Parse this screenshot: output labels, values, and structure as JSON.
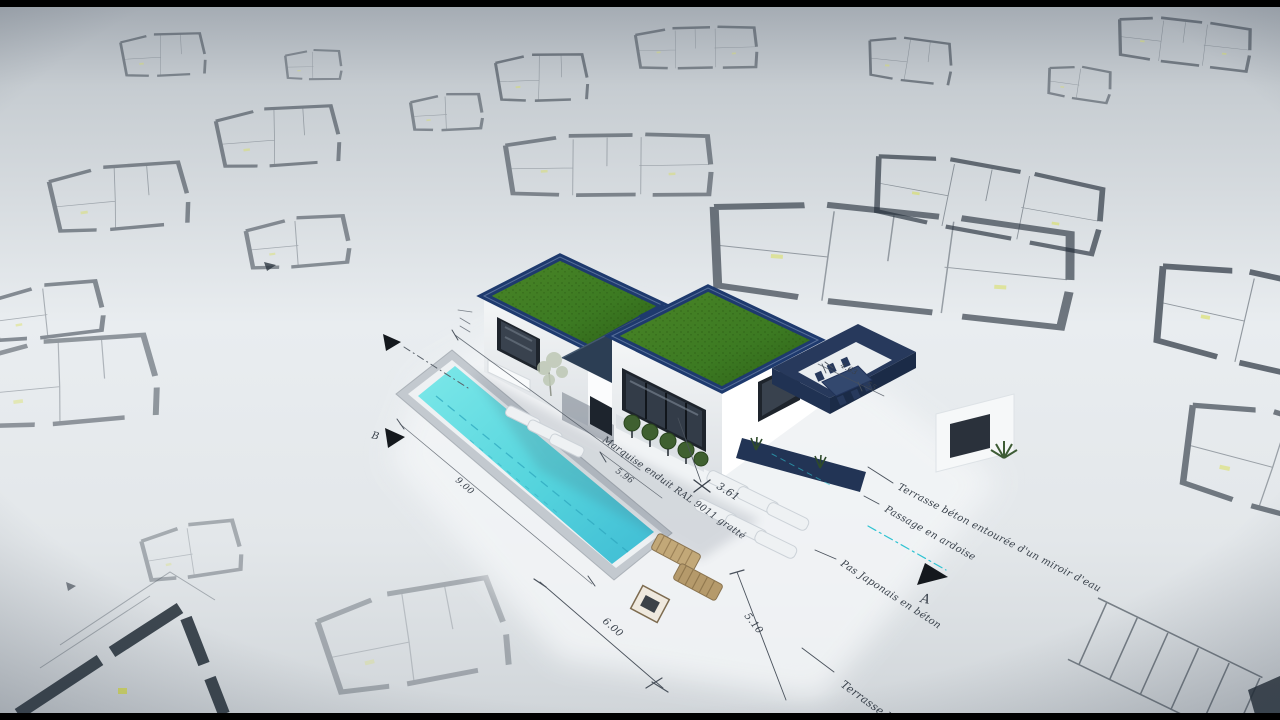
{
  "annotations": {
    "marquise": "Marquise enduit RAL 9011 gratté",
    "terrasse_miroir": "Terrasse béton entourée d'un miroir d'eau",
    "passage_ardoise": "Passage en ardoise",
    "pas_japonais": "Pas Japonais en béton",
    "terrasse_partial": "Terrasse b"
  },
  "dimensions": {
    "pool_length": "9.00",
    "terrace_width": "6.00",
    "terrace_depth": "5.10",
    "facade_front": "5.96",
    "entry_axis": "3.61",
    "pergola_width": "4.63",
    "pergola_offset": "55"
  },
  "markers": {
    "section_a": "A",
    "section_b": "B"
  },
  "colors": {
    "pool_water": "#55d4dd",
    "roof_grass": "#3c7a22",
    "roof_parapet": "#1e3a6e",
    "canopy": "#2c3e54",
    "pergola": "#24365c",
    "annotation_ink": "#39414b",
    "guide_cyan": "#2fc3d2",
    "plan_accent_yellow": "#d9df57"
  }
}
